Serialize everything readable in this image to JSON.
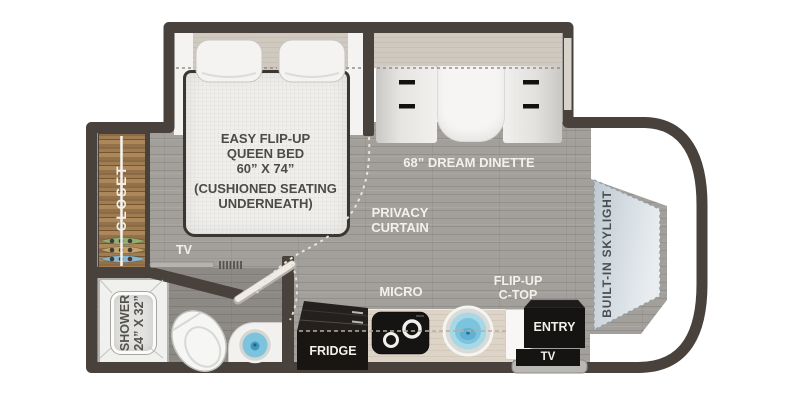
{
  "plan": {
    "bedroom": {
      "bed_title_lines": [
        "EASY FLIP-UP",
        "QUEEN BED",
        "60” X 74”"
      ],
      "bed_note_lines": [
        "(CUSHIONED SEATING",
        "UNDERNEATH)"
      ],
      "closet_label": "CLOSET",
      "tv_label": "TV",
      "privacy_curtain_lines": [
        "PRIVACY",
        "CURTAIN"
      ]
    },
    "dinette": {
      "label": "68” DREAM DINETTE"
    },
    "kitchen": {
      "micro_label": "MICRO",
      "fridge_label": "FRIDGE",
      "flip_up_counter_lines": [
        "FLIP-UP",
        "C-TOP"
      ]
    },
    "bathroom": {
      "shower_lines": [
        "SHOWER",
        "24” X 32”"
      ]
    },
    "entry": {
      "entry_label": "ENTRY",
      "tv_label": "TV"
    },
    "cab": {
      "skylight_label": "BUILT-IN SKYLIGHT"
    }
  },
  "colors": {
    "wall": "#49413c",
    "floor": "#a3a09c",
    "closet_wood": "#96734b",
    "counter": "#ddd4c7",
    "sink_water": "#7cc3dd",
    "skylight": "#ccd5db",
    "appliance_black": "#161412",
    "label_light": "#f3f0ea",
    "label_dark": "#4e4b47"
  }
}
